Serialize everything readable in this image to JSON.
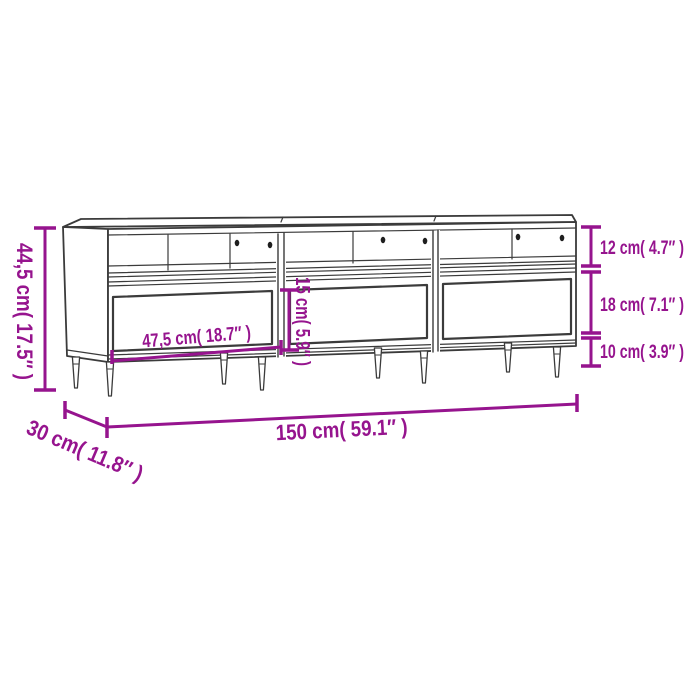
{
  "page": {
    "background": "#ffffff"
  },
  "colors": {
    "dimension_accent": "#96148E",
    "drawing_line": "#3B3B3B"
  },
  "dimensions": {
    "overall_height": "44,5 cm( 17.5″ )",
    "drawer_width": "47,5 cm( 18.7″ )",
    "drawer_front_height": "15 cm( 5.9″ )",
    "top_compartment_height": "12 cm( 4.7″ )",
    "drawer_section_height": "18 cm( 7.1″ )",
    "leg_height": "10 cm( 3.9″ )",
    "overall_width": "150 cm( 59.1″ )",
    "overall_depth": "30 cm( 11.8″ )"
  }
}
